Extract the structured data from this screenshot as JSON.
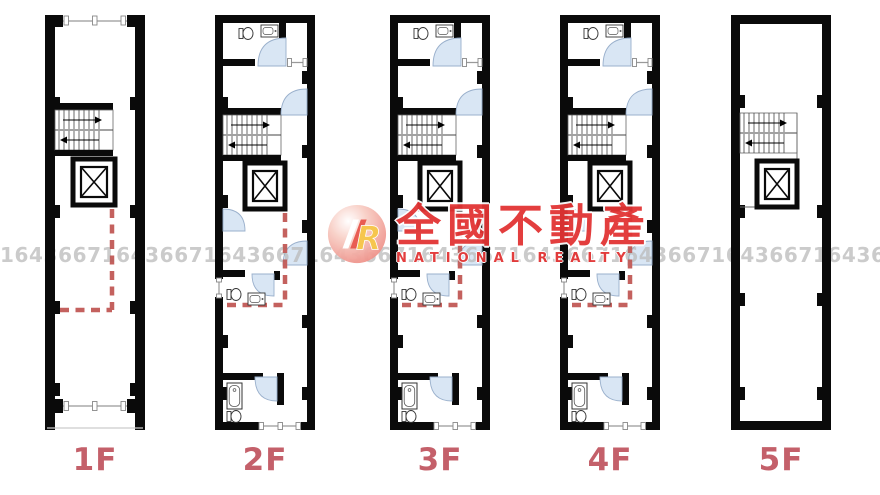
{
  "floors": [
    {
      "label": "1F",
      "type": "first"
    },
    {
      "label": "2F",
      "type": "mid"
    },
    {
      "label": "3F",
      "type": "mid"
    },
    {
      "label": "4F",
      "type": "mid"
    },
    {
      "label": "5F",
      "type": "top"
    }
  ],
  "watermark": {
    "serial_unit": "1643667",
    "serial_text": "16436671643667164366716436671643667164366716436671643667164366716436671643667",
    "brand_cjk": "全國不動產",
    "brand_en": "NATIONAL REALTY",
    "logo_letter": "R"
  },
  "colors": {
    "wall_black": "#0a0a0a",
    "floor_label_red": "#c4606a",
    "dashed_boundary_red": "#c4615e",
    "door_arc_fill": "#d9e6f4",
    "brand_red": "#e23434",
    "logo_pink": "#f2948c",
    "logo_yellow": "#f6c445",
    "serial_gray": "#b9b9b9"
  }
}
